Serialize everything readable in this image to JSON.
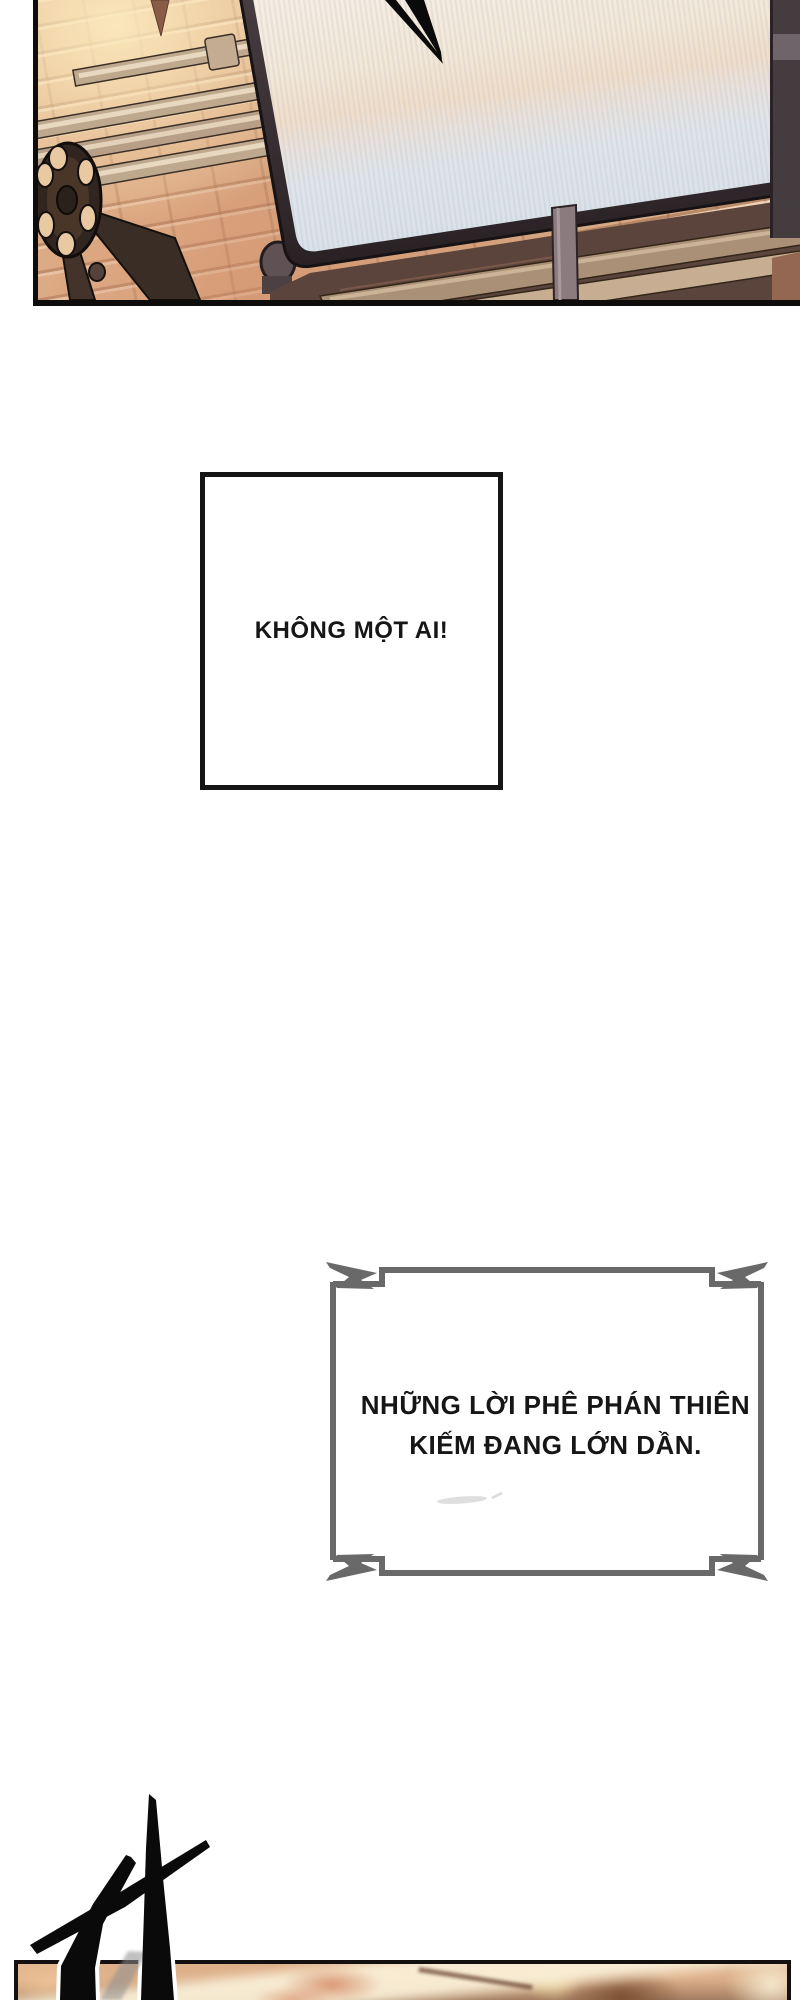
{
  "page": {
    "background": "#ffffff",
    "width": 800,
    "height": 2000
  },
  "panel_top": {
    "brick_color": "#e0b38c",
    "brick_highlight": "#fce9bd",
    "pipe_color": "#bfa98e",
    "screen_frame_color": "#393033",
    "screen_sky_color": "#f6efe7",
    "screen_sea_color": "#dbe1e8",
    "border_color": "#0f0c0c"
  },
  "speech_boxes": {
    "box1": {
      "text": "KHÔNG MỘT AI!",
      "border_color": "#151515",
      "text_color": "#161616"
    },
    "box2": {
      "line1": "NHỮNG LỜI PHÊ PHÁN THIÊN",
      "line2": "KIẾM ĐANG LỚN DẦN.",
      "border_color": "#696969",
      "text_color": "#161616"
    }
  },
  "panel_bottom": {
    "border_color": "#141010",
    "skin_tone": "#ddb08a",
    "stroke_color": "#0a0a0a"
  }
}
